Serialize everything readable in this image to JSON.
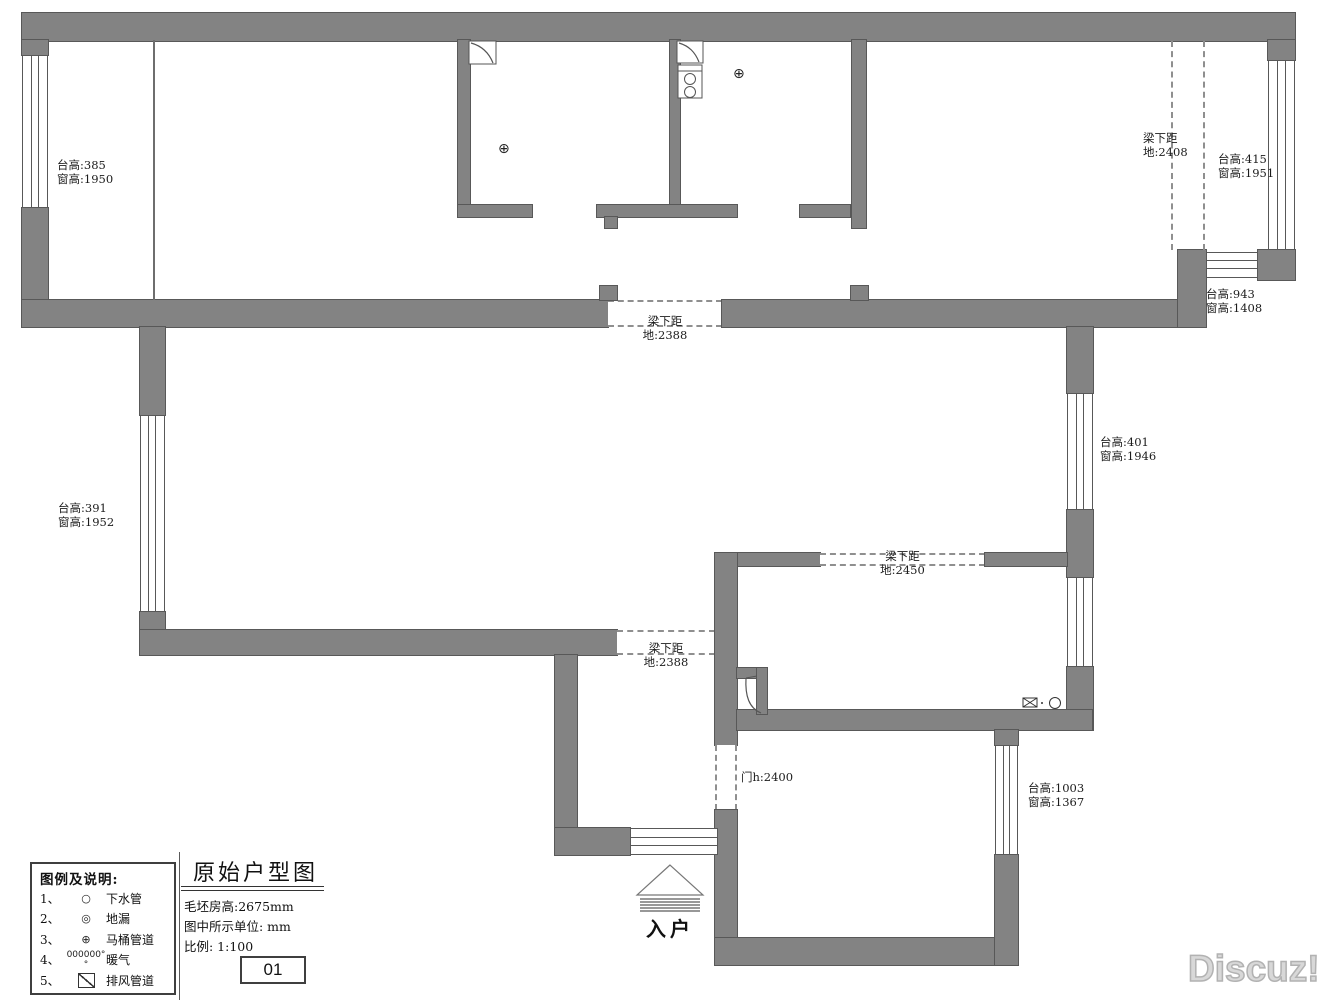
{
  "annotations": {
    "win_tl": {
      "line1": "台高:385",
      "line2": "窗高:1950"
    },
    "beam_tr": {
      "line1": "梁下距",
      "line2": "地:2408"
    },
    "win_tr": {
      "line1": "台高:415",
      "line2": "窗高:1951"
    },
    "win_bay": {
      "line1": "台高:943",
      "line2": "窗高:1408"
    },
    "beam_mid": {
      "line1": "梁下距",
      "line2": "地:2388"
    },
    "win_right": {
      "line1": "台高:401",
      "line2": "窗高:1946"
    },
    "win_left": {
      "line1": "台高:391",
      "line2": "窗高:1952"
    },
    "beam_2450": {
      "line1": "梁下距",
      "line2": "地:2450"
    },
    "beam_2388b": {
      "line1": "梁下距",
      "line2": "地:2388"
    },
    "door_h": {
      "line1": "门h:2400"
    },
    "win_br": {
      "line1": "台高:1003",
      "line2": "窗高:1367"
    }
  },
  "symbols": {
    "toilet_glyph": "⊕",
    "drain_glyph": "○",
    "floordrain_glyph": "◎"
  },
  "legend": {
    "title": "图例及说明:",
    "items": [
      {
        "no": "1、",
        "glyph": "○",
        "label": "下水管"
      },
      {
        "no": "2、",
        "glyph": "◎",
        "label": "地漏"
      },
      {
        "no": "3、",
        "glyph": "⊕",
        "label": "马桶管道"
      },
      {
        "no": "4、",
        "glyph": "000000°°",
        "label": "暖气"
      },
      {
        "no": "5、",
        "glyph": "",
        "label": "排风管道"
      }
    ]
  },
  "titleblock": {
    "title": "原始户型图",
    "info": [
      "毛坯房高:2675mm",
      "图中所示单位: mm",
      "比例: 1:100"
    ],
    "sheet_no": "01"
  },
  "entrance_label": "入户",
  "watermark": "Discuz!",
  "colors": {
    "wall": "#838383",
    "wall_edge": "#585858",
    "dash": "#8f8f8f",
    "text": "#1c1c1c",
    "watermark": "#d8d8d8"
  }
}
